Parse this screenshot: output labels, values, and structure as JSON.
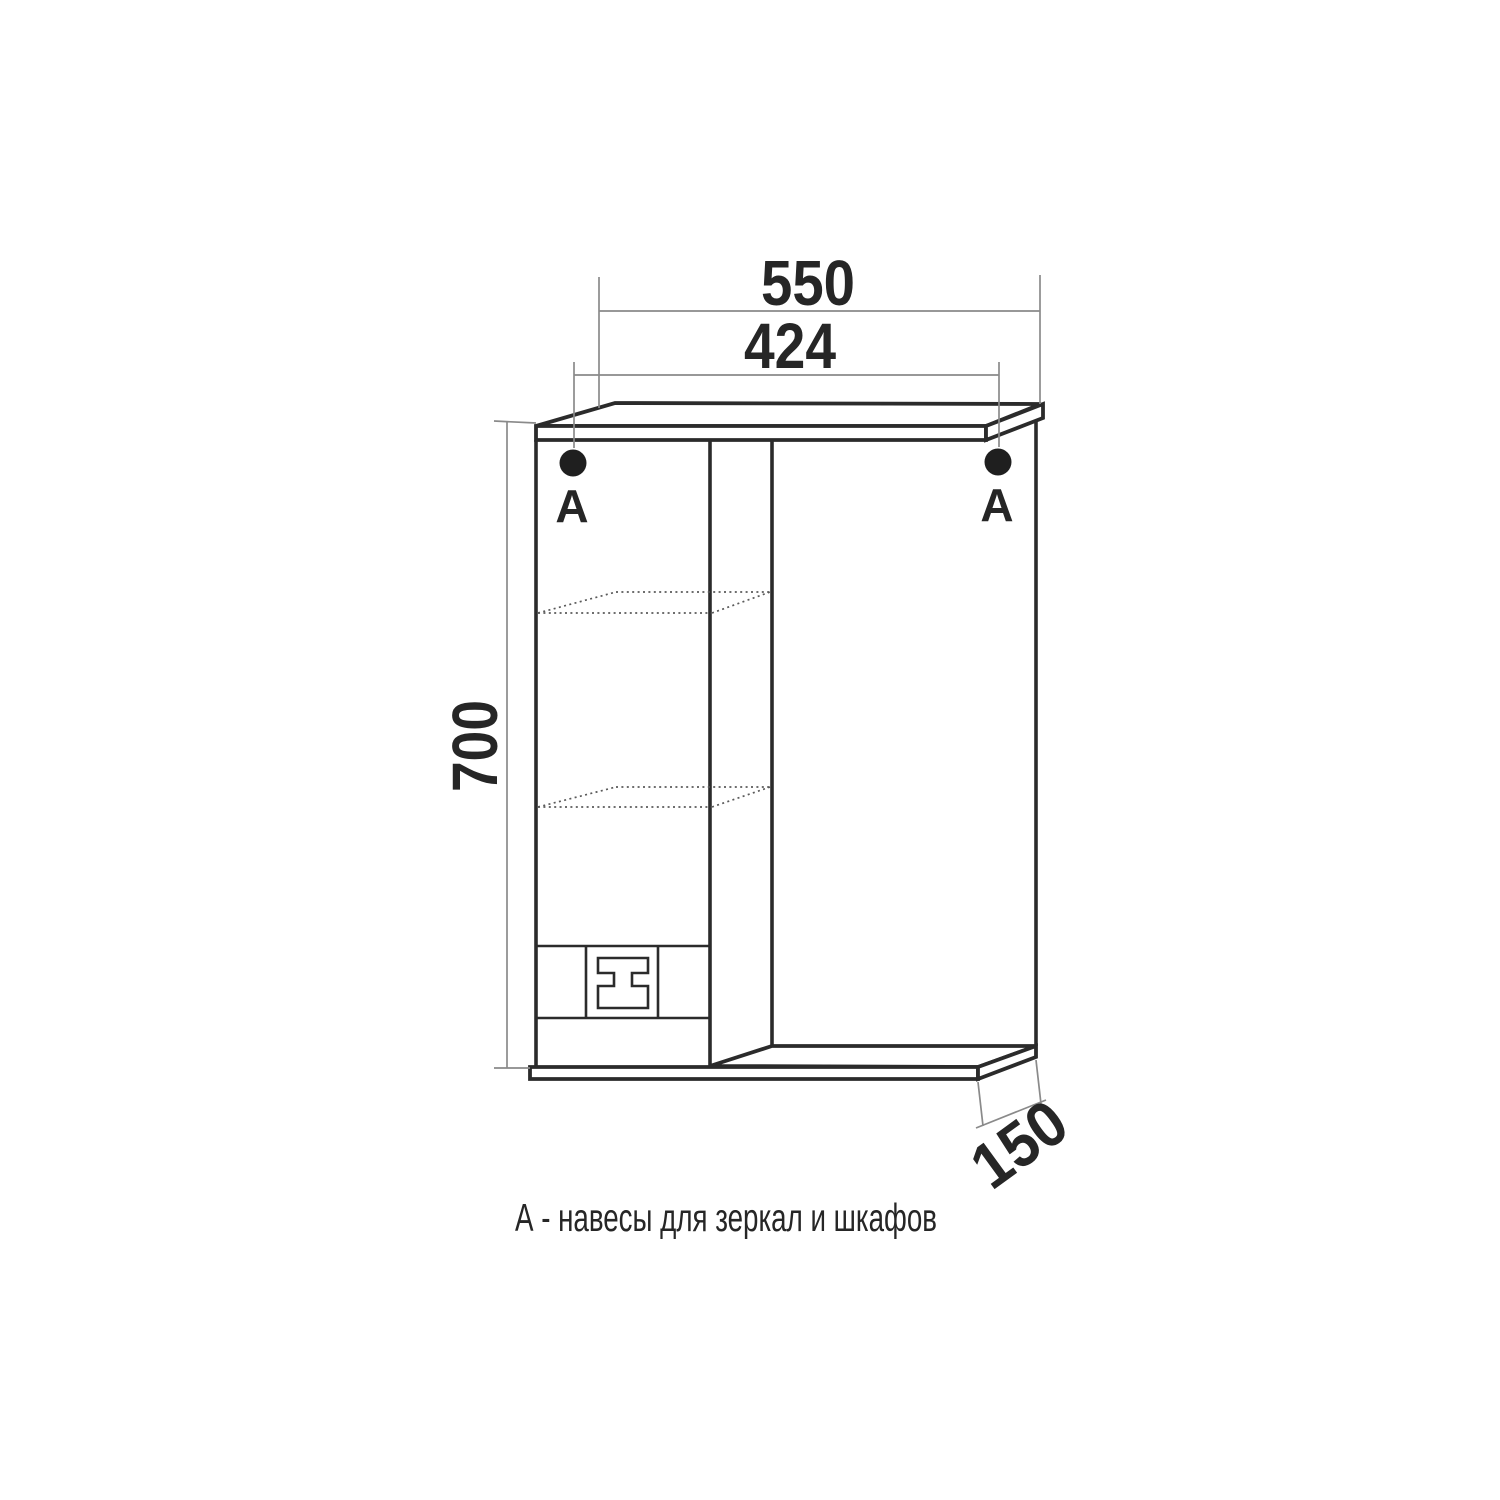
{
  "figure": {
    "type": "furniture-technical-drawing",
    "caption": "А - навесы для зеркал и шкафов",
    "dimensions": {
      "overall_width_mm": "550",
      "mount_spacing_mm": "424",
      "height_mm": "700",
      "depth_mm": "150"
    },
    "markers": {
      "left_label": "А",
      "right_label": "А"
    },
    "colors": {
      "line": "#2b2b2b",
      "dim": "#8a8a8a",
      "text": "#262626",
      "dot": "#1f1f1f",
      "background": "#ffffff"
    }
  }
}
